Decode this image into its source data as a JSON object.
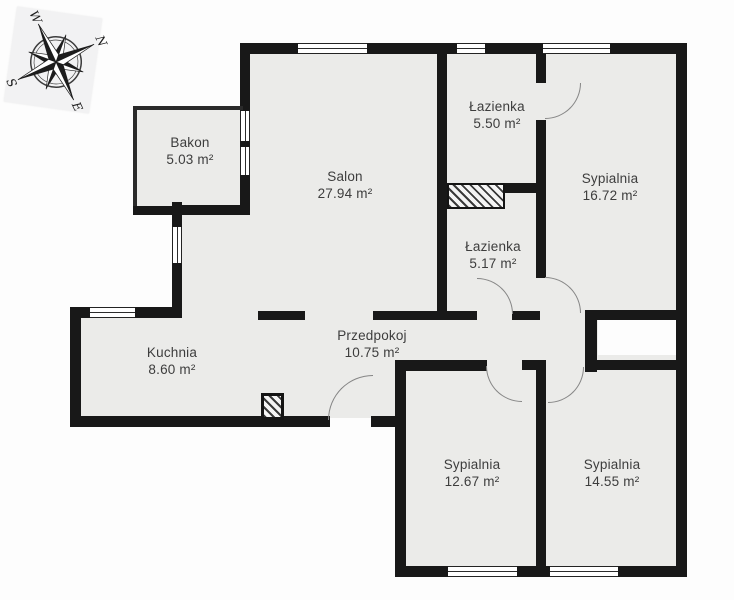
{
  "plan": {
    "type": "apartment-floor-plan",
    "language": "pl",
    "colors": {
      "wall": "#181818",
      "floor": "#ebebe9",
      "background": "#ffffff",
      "label_text": "#3d3d3d",
      "door_arc": "#858585"
    }
  },
  "compass": {
    "icon": "compass-rose-icon",
    "rotation_note": "north points upper-right",
    "n": "N",
    "e": "E",
    "s": "S",
    "w": "W"
  },
  "rooms": [
    {
      "id": "bakon",
      "name": "Bakon",
      "area": "5.03 m²"
    },
    {
      "id": "salon",
      "name": "Salon",
      "area": "27.94 m²"
    },
    {
      "id": "lazienka-1",
      "name": "Łazienka",
      "area": "5.50 m²"
    },
    {
      "id": "sypialnia-1",
      "name": "Sypialnia",
      "area": "16.72 m²"
    },
    {
      "id": "lazienka-2",
      "name": "Łazienka",
      "area": "5.17 m²"
    },
    {
      "id": "przedpokoj",
      "name": "Przedpokoj",
      "area": "10.75 m²"
    },
    {
      "id": "kuchnia",
      "name": "Kuchnia",
      "area": "8.60 m²"
    },
    {
      "id": "sypialnia-2",
      "name": "Sypialnia",
      "area": "12.67 m²"
    },
    {
      "id": "sypialnia-3",
      "name": "Sypialnia",
      "area": "14.55 m²"
    }
  ]
}
